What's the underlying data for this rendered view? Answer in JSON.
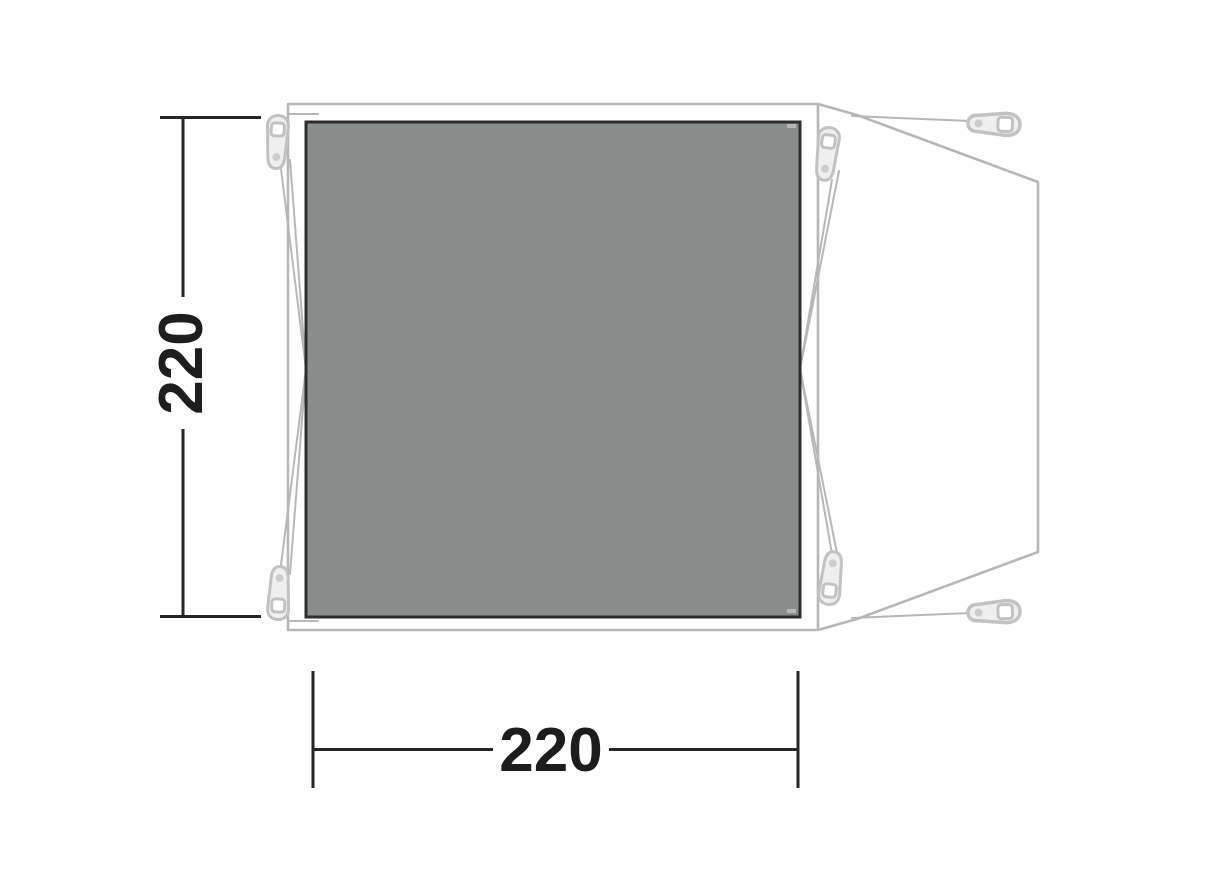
{
  "diagram": {
    "title": "tent-footprint-top-view",
    "dimensions": {
      "depth": {
        "value": "220",
        "orientation": "vertical"
      },
      "width": {
        "value": "220",
        "orientation": "horizontal"
      }
    },
    "colors": {
      "background": "#ffffff",
      "groundsheet_fill": "#898e8c",
      "groundsheet_border": "#2d2d2d",
      "outline_stroke": "#b7b7b7",
      "hardware_fill": "#efefef",
      "hardware_stroke": "#c2c2c2",
      "dimension_stroke": "#262626",
      "label_color": "#1d1d1d"
    }
  }
}
